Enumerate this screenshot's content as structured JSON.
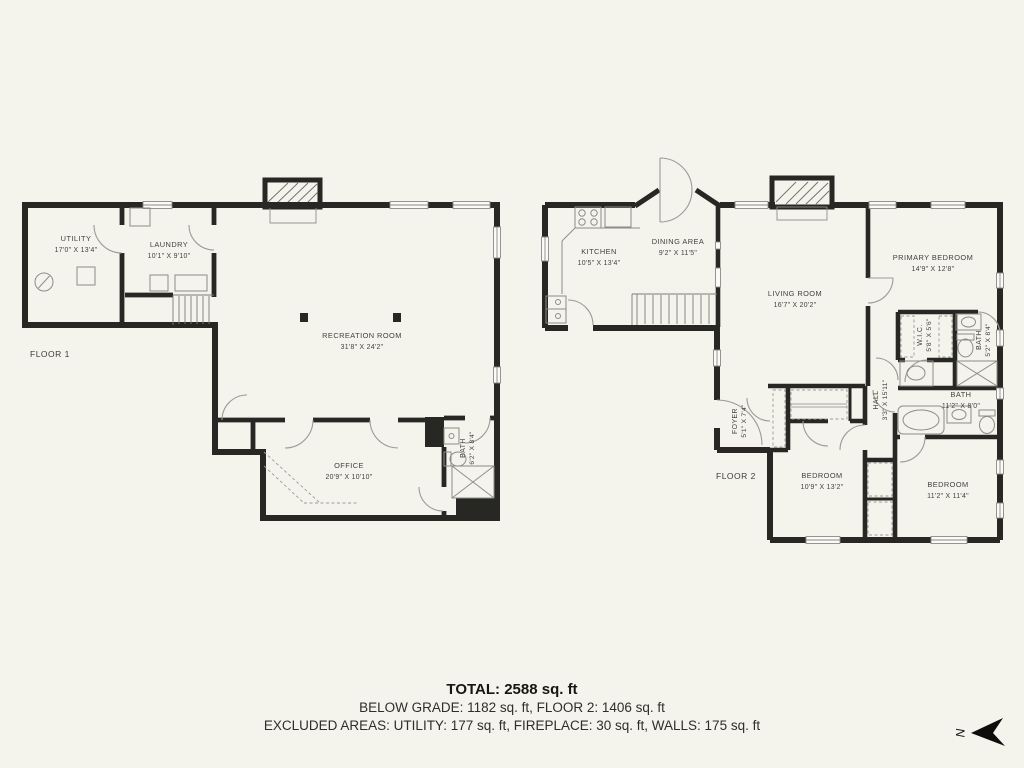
{
  "page": {
    "background": "#f4f3ec",
    "wall_color": "#272724"
  },
  "floor1": {
    "label": "FLOOR 1",
    "rooms": {
      "utility": {
        "name": "UTILITY",
        "dims": "17'0\" X 13'4\""
      },
      "laundry": {
        "name": "LAUNDRY",
        "dims": "10'1\" X 9'10\""
      },
      "recreation": {
        "name": "RECREATION ROOM",
        "dims": "31'8\" X 24'2\""
      },
      "office": {
        "name": "OFFICE",
        "dims": "20'9\" X 10'10\""
      },
      "bath": {
        "name": "BATH",
        "dims": "6'2\" X 8'4\""
      }
    }
  },
  "floor2": {
    "label": "FLOOR 2",
    "rooms": {
      "kitchen": {
        "name": "KITCHEN",
        "dims": "10'5\" X 13'4\""
      },
      "dining": {
        "name": "DINING AREA",
        "dims": "9'2\" X 11'5\""
      },
      "living": {
        "name": "LIVING ROOM",
        "dims": "16'7\" X 20'2\""
      },
      "primary": {
        "name": "PRIMARY BEDROOM",
        "dims": "14'9\" X 12'8\""
      },
      "wic": {
        "name": "W.I.C.",
        "dims": "5'8\" X 5'6\""
      },
      "primary_bath": {
        "name": "BATH",
        "dims": "5'2\" X 8'4\""
      },
      "foyer": {
        "name": "FOYER",
        "dims": "5'1\" X 7'4\""
      },
      "hall": {
        "name": "HALL",
        "dims": "3'3\" X 15'11\""
      },
      "bath": {
        "name": "BATH",
        "dims": "11'2\" X 8'0\""
      },
      "bedroom_left": {
        "name": "BEDROOM",
        "dims": "10'9\" X 13'2\""
      },
      "bedroom_right": {
        "name": "BEDROOM",
        "dims": "11'2\" X 11'4\""
      }
    }
  },
  "summary": {
    "total": "TOTAL: 2588 sq. ft",
    "breakdown": "BELOW GRADE: 1182 sq. ft, FLOOR 2: 1406 sq. ft",
    "excluded": "EXCLUDED AREAS: UTILITY: 177 sq. ft, FIREPLACE: 30 sq. ft, WALLS: 175 sq. ft"
  },
  "compass": {
    "letter": "N",
    "icon": "north-arrow-icon"
  }
}
